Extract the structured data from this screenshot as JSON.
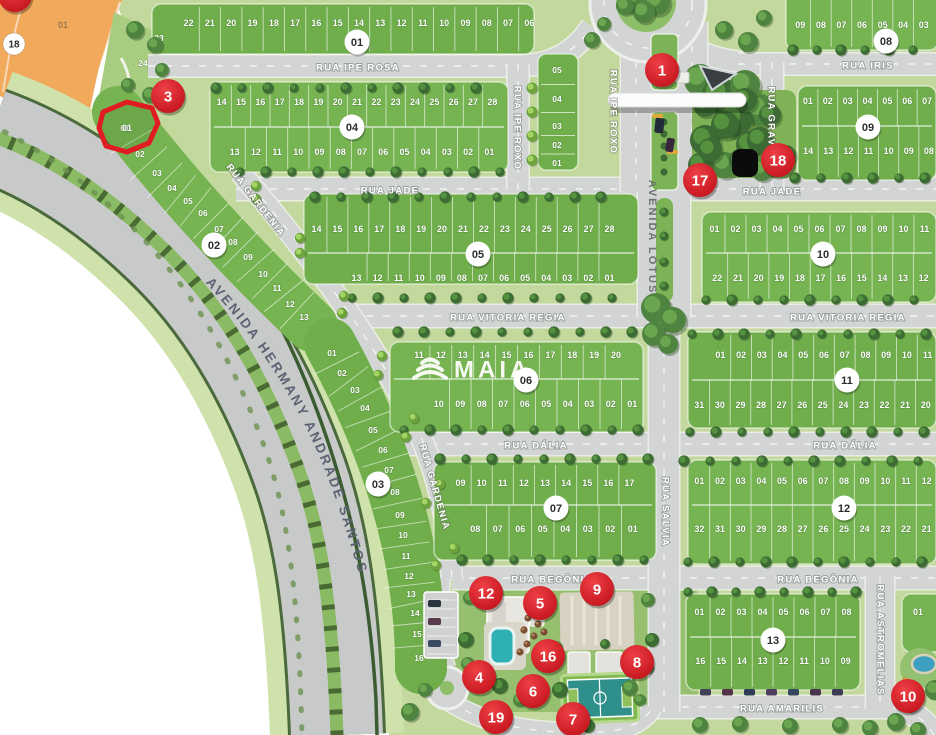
{
  "brand": {
    "watermark": "MAIA"
  },
  "avenue_label": "AVENIDA HERMANY ANDRADE SANTOS",
  "streets": {
    "ipe_rosa": "RUA IPE ROSA",
    "jade_left": "RUA JADE",
    "jade_right": "RUA JADE",
    "vitoria_left": "RUA VITORIA REGIA",
    "vitoria_right": "RUA VITORIA REGIA",
    "dalia_left": "RUA DÁLIA",
    "dalia_right": "RUA DÁLIA",
    "begonia_left": "RUA BEGÔNIA",
    "begonia_right": "RUA BEGÔNIA",
    "amarilis": "RUA AMARILIS",
    "iris": "RUA IRIS",
    "lotus": "AVENIDA LÓTUS",
    "salvia": "RUA SALVIA",
    "gardenia_upper": "RUA GARDENIA",
    "gardenia_lower": "RUA GARDENIA",
    "ipe_roxo": "RUA IPE ROXO",
    "ipe_roxo_entry": "RUA IPE ROXO",
    "gravata": "RUA GRAVATA",
    "astromelias": "RUA ASTROMELIAS"
  },
  "blocks": [
    {
      "id": "01",
      "badge": "01",
      "lots_top": [
        "22",
        "21",
        "20",
        "19",
        "18",
        "17",
        "16",
        "15",
        "14",
        "13",
        "12",
        "11",
        "10",
        "09",
        "08",
        "07",
        "06"
      ],
      "lots_tail": [
        "05",
        "04",
        "03",
        "02",
        "01"
      ],
      "lots_side": [
        "23",
        "24"
      ]
    },
    {
      "id": "02",
      "badge": "02",
      "lots": [
        "01",
        "02",
        "03",
        "04",
        "05",
        "06",
        "07",
        "08",
        "09",
        "10",
        "11",
        "12",
        "13"
      ]
    },
    {
      "id": "03",
      "badge": "03",
      "lots": [
        "01",
        "02",
        "03",
        "04",
        "05",
        "06",
        "07",
        "08",
        "09",
        "10",
        "11",
        "12",
        "13",
        "14",
        "15",
        "16"
      ]
    },
    {
      "id": "04",
      "badge": "04",
      "lots_top": [
        "14",
        "15",
        "16",
        "17",
        "18",
        "19",
        "20",
        "21",
        "22",
        "23",
        "24",
        "25",
        "26",
        "27",
        "28"
      ],
      "lots_bottom": [
        "13",
        "12",
        "11",
        "10",
        "09",
        "08",
        "07",
        "06",
        "05",
        "04",
        "03",
        "02",
        "01"
      ]
    },
    {
      "id": "05",
      "badge": "05",
      "lots_top": [
        "14",
        "15",
        "16",
        "17",
        "18",
        "19",
        "20",
        "21",
        "22",
        "23",
        "24",
        "25",
        "26",
        "27",
        "28"
      ],
      "lots_bottom": [
        "13",
        "12",
        "11",
        "10",
        "09",
        "08",
        "07",
        "06",
        "05",
        "04",
        "03",
        "02",
        "01"
      ]
    },
    {
      "id": "06",
      "badge": "06",
      "lots_top": [
        "11",
        "12",
        "13",
        "14",
        "15",
        "16",
        "17",
        "18",
        "19",
        "20"
      ],
      "lots_bottom": [
        "10",
        "09",
        "08",
        "07",
        "06",
        "05",
        "04",
        "03",
        "02",
        "01"
      ]
    },
    {
      "id": "07",
      "badge": "07",
      "lots_top": [
        "09",
        "10",
        "11",
        "12",
        "13",
        "14",
        "15",
        "16",
        "17"
      ],
      "lots_bottom": [
        "08",
        "07",
        "06",
        "05",
        "04",
        "03",
        "02",
        "01"
      ]
    },
    {
      "id": "08",
      "badge": "08",
      "lots_top": [
        "09",
        "08",
        "07",
        "06",
        "05",
        "04",
        "03"
      ]
    },
    {
      "id": "09",
      "badge": "09",
      "lots_top": [
        "01",
        "02",
        "03",
        "04",
        "05",
        "06",
        "07"
      ],
      "lots_bottom": [
        "14",
        "13",
        "12",
        "11",
        "10",
        "09",
        "08"
      ]
    },
    {
      "id": "10",
      "badge": "10",
      "lots_top": [
        "01",
        "02",
        "03",
        "04",
        "05",
        "06",
        "07",
        "08",
        "09",
        "10",
        "11"
      ],
      "lots_bottom": [
        "22",
        "21",
        "20",
        "19",
        "18",
        "17",
        "16",
        "15",
        "14",
        "13",
        "12"
      ]
    },
    {
      "id": "11",
      "badge": "11",
      "lots_top": [
        "01",
        "02",
        "03",
        "04",
        "05",
        "06",
        "07",
        "08",
        "09",
        "10",
        "11"
      ],
      "lots_bottom": [
        "31",
        "30",
        "29",
        "28",
        "27",
        "26",
        "25",
        "24",
        "23",
        "22",
        "21",
        "20"
      ]
    },
    {
      "id": "12",
      "badge": "12",
      "lots_top": [
        "01",
        "02",
        "03",
        "04",
        "05",
        "06",
        "07",
        "08",
        "09",
        "10",
        "11",
        "12"
      ],
      "lots_bottom": [
        "32",
        "31",
        "30",
        "29",
        "28",
        "27",
        "26",
        "25",
        "24",
        "23",
        "22",
        "21"
      ]
    },
    {
      "id": "13",
      "badge": "13",
      "lots_top": [
        "01",
        "02",
        "03",
        "04",
        "05",
        "06",
        "07",
        "08"
      ],
      "lots_bottom": [
        "16",
        "15",
        "14",
        "13",
        "12",
        "11",
        "10",
        "09"
      ]
    },
    {
      "id": "13b",
      "badge": "",
      "lots_top": [
        "01"
      ]
    }
  ],
  "markers": [
    {
      "label": "1"
    },
    {
      "label": "3"
    },
    {
      "label": "17"
    },
    {
      "label": "18"
    },
    {
      "label": "12"
    },
    {
      "label": "5"
    },
    {
      "label": "9"
    },
    {
      "label": "16"
    },
    {
      "label": "8"
    },
    {
      "label": "4"
    },
    {
      "label": "6"
    },
    {
      "label": "19"
    },
    {
      "label": "7"
    },
    {
      "label": "10"
    },
    {
      "label": ""
    }
  ],
  "orange_zone": {
    "badge": "18",
    "faint_label": "01"
  },
  "highlight_lot": {
    "label": "01"
  },
  "colors": {
    "marker_red": "#d81f26",
    "block_green": "#6fae4b",
    "zone_orange": "#f1a95b",
    "road_gray": "#d2d5d3",
    "highlight_red": "#e01b22",
    "pool_teal": "#2fb0b4"
  }
}
